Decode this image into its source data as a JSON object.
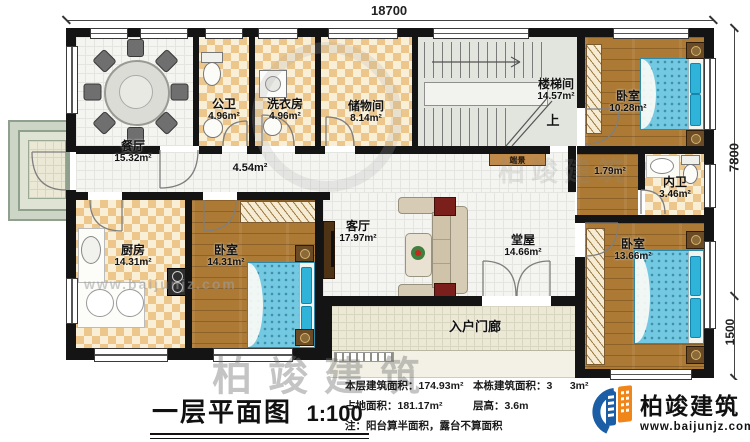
{
  "plan": {
    "dimensions": {
      "width_top": "18700",
      "height_main": "7800",
      "height_front": "1500"
    },
    "rooms": {
      "dining": {
        "name": "餐厅",
        "area": "15.32m²"
      },
      "public_bath": {
        "name": "公卫",
        "area": "4.96m²"
      },
      "laundry": {
        "name": "洗衣房",
        "area": "4.96m²"
      },
      "storage": {
        "name": "储物间",
        "area": "8.14m²"
      },
      "stairwell": {
        "name": "楼梯间",
        "area": "14.57m²",
        "up": "上"
      },
      "bedroom_top_right": {
        "name": "卧室",
        "area": "10.28m²"
      },
      "inner_hall": {
        "area": "1.79m²"
      },
      "ensuite_bath": {
        "name": "内卫",
        "area": "3.46m²"
      },
      "corridor": {
        "area": "4.54m²"
      },
      "kitchen": {
        "name": "厨房",
        "area": "14.31m²"
      },
      "bedroom_bottom_left": {
        "name": "卧室",
        "area": "14.31m²"
      },
      "living": {
        "name": "客厅",
        "area": "17.97m²"
      },
      "main_hall": {
        "name": "堂屋",
        "area": "14.66m²"
      },
      "bedroom_bottom_right": {
        "name": "卧室",
        "area": "13.66m²"
      },
      "porch": {
        "name": "入户门廊"
      },
      "console": {
        "name": "端景"
      }
    }
  },
  "title_block": {
    "title": "一层平面图",
    "scale": "1:100"
  },
  "stats": {
    "floor_area_label": "本层建筑面积：",
    "floor_area_value": "174.93m²",
    "building_area_label": "本栋建筑面积：",
    "building_area_value": "3      3m²",
    "land_area_label": "占地面积：",
    "land_area_value": "181.17m²",
    "floor_height_label": "层高：",
    "floor_height_value": "3.6m",
    "note": "注：阳台算半面积，露台不算面积"
  },
  "logo": {
    "name": "柏竣建筑",
    "url": "www.baijunjz.com"
  },
  "watermark": {
    "brand": "柏竣建筑",
    "url": "www.baijunjz.com"
  },
  "colors": {
    "wall": "#141414",
    "checker": "#ecc68a",
    "wood": "#ac7a35",
    "bed": "#74c9e2",
    "logo_blue": "#1b5ea6",
    "logo_orange": "#f08519"
  }
}
